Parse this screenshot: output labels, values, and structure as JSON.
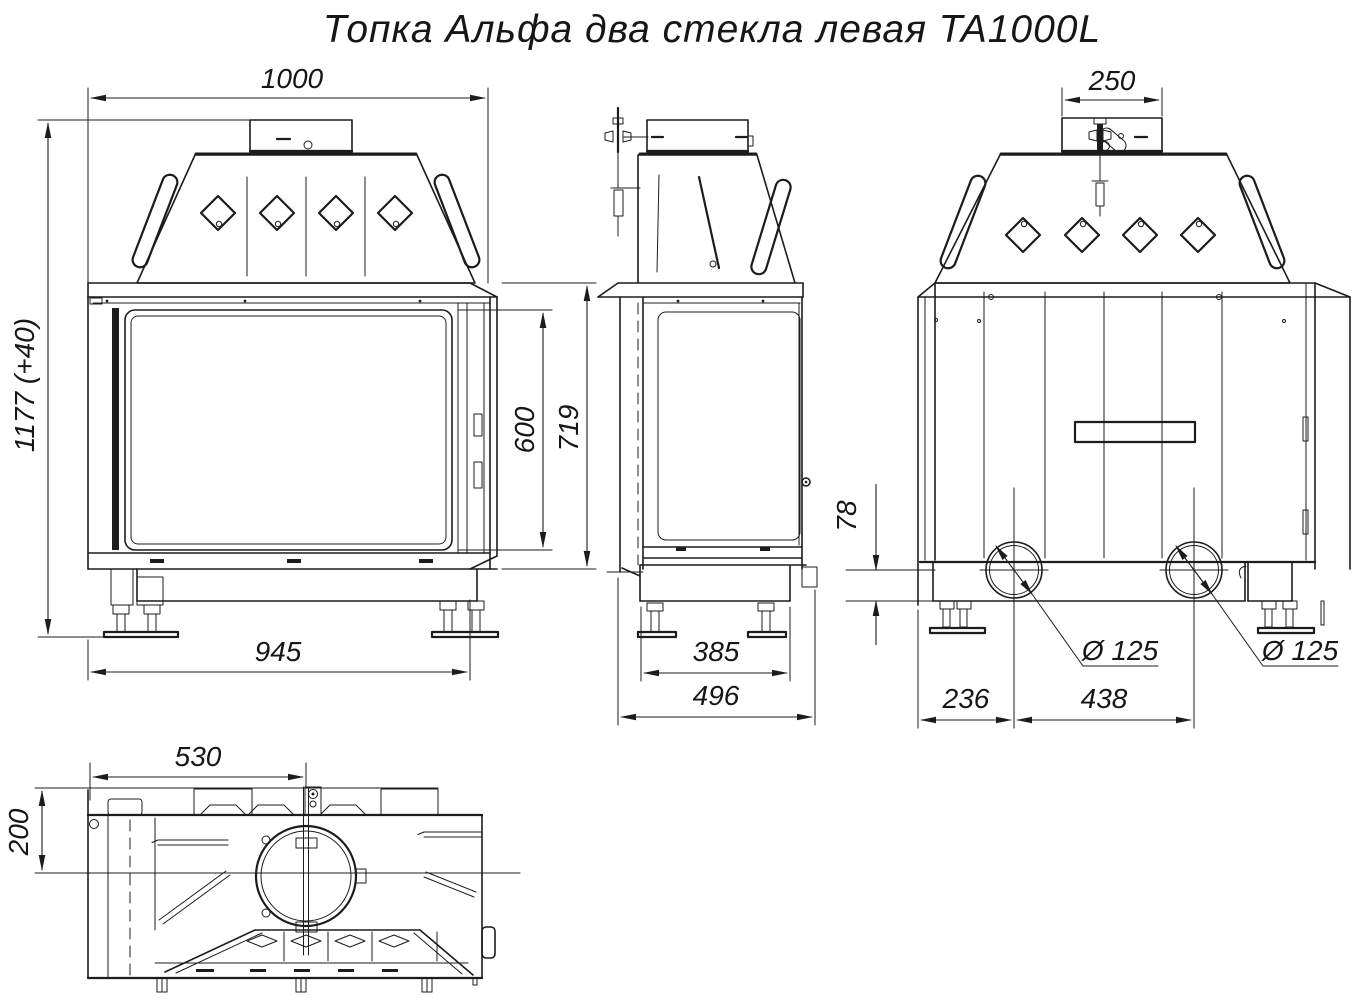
{
  "title": "Топка Альфа два стекла левая TA1000L",
  "drawing": {
    "type": "technical-drawing",
    "product": "fireplace-insert",
    "views": {
      "front": {
        "dim_overall_width": "1000",
        "dim_overall_height": "1177 (+40)",
        "dim_glass_height": "600",
        "dim_body_height": "719",
        "dim_base_width": "945"
      },
      "side": {
        "dim_base_depth": "385",
        "dim_total_depth": "496"
      },
      "back": {
        "dim_collar_width": "250",
        "dim_base_height": "78",
        "dim_outlet_left": "Ø 125",
        "dim_outlet_right": "Ø 125",
        "dim_outlet_offset": "236",
        "dim_outlet_spacing": "438"
      },
      "plan": {
        "dim_flue_center_x": "530",
        "dim_flue_center_y": "200"
      }
    },
    "colors": {
      "line": "#1c1c1c",
      "background": "#ffffff"
    }
  }
}
